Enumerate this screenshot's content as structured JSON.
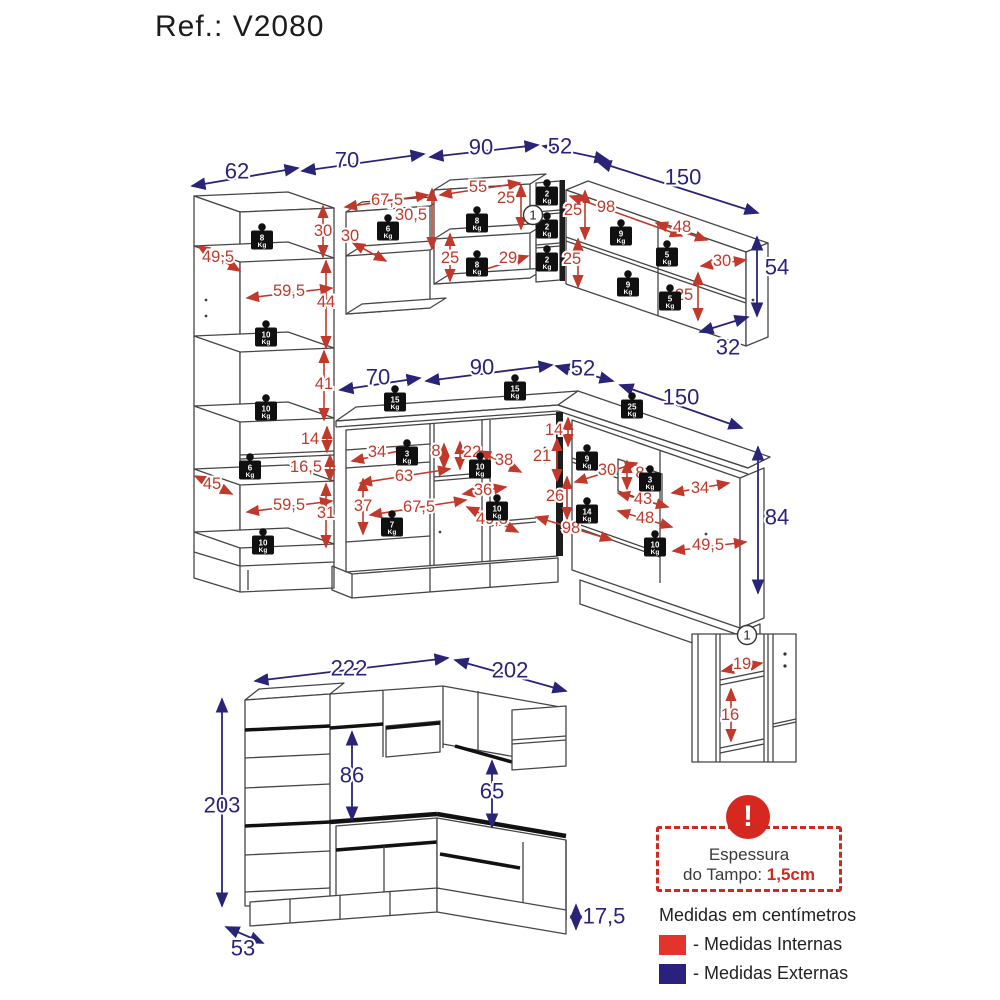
{
  "title": "Ref.: V2080",
  "colors": {
    "internal": "#c0392b",
    "external": "#2a2478",
    "legend_internal": "#e2342a",
    "legend_external": "#2a2080",
    "warning": "#d6281e"
  },
  "legend": {
    "thickness_line1": "Espessura",
    "thickness_line2": "do Tampo: ",
    "thickness_value": "1,5cm",
    "warning_glyph": "!",
    "units_note": "Medidas em centímetros",
    "internal_label": "- Medidas Internas",
    "external_label": "- Medidas Externas"
  },
  "diagram": {
    "dims": [
      {
        "t": "62",
        "x": 237,
        "y": 171,
        "c": "e",
        "a": [
          192,
          186,
          298,
          168
        ]
      },
      {
        "t": "70",
        "x": 347,
        "y": 160,
        "c": "e",
        "a": [
          302,
          171,
          424,
          154
        ]
      },
      {
        "t": "90",
        "x": 481,
        "y": 147,
        "c": "e",
        "a": [
          430,
          157,
          538,
          145
        ]
      },
      {
        "t": "52",
        "x": 560,
        "y": 146,
        "c": "e",
        "a": [
          543,
          146,
          608,
          160
        ]
      },
      {
        "t": "150",
        "x": 683,
        "y": 177,
        "c": "e",
        "a": [
          598,
          162,
          758,
          213
        ]
      },
      {
        "t": "54",
        "x": 777,
        "y": 267,
        "c": "e",
        "a": [
          757,
          237,
          757,
          316
        ]
      },
      {
        "t": "32",
        "x": 728,
        "y": 347,
        "c": "e",
        "a": [
          700,
          332,
          748,
          317
        ]
      },
      {
        "t": "70",
        "x": 378,
        "y": 377,
        "c": "e",
        "a": [
          340,
          390,
          420,
          378
        ]
      },
      {
        "t": "90",
        "x": 482,
        "y": 367,
        "c": "e",
        "a": [
          426,
          381,
          552,
          365
        ]
      },
      {
        "t": "52",
        "x": 583,
        "y": 368,
        "c": "e",
        "a": [
          556,
          366,
          613,
          381
        ]
      },
      {
        "t": "150",
        "x": 681,
        "y": 397,
        "c": "e",
        "a": [
          620,
          385,
          742,
          428
        ]
      },
      {
        "t": "84",
        "x": 777,
        "y": 517,
        "c": "e",
        "a": [
          758,
          447,
          758,
          593
        ]
      },
      {
        "t": "222",
        "x": 349,
        "y": 668,
        "c": "e",
        "a": [
          255,
          681,
          448,
          658
        ]
      },
      {
        "t": "202",
        "x": 510,
        "y": 670,
        "c": "e",
        "a": [
          455,
          660,
          566,
          691
        ]
      },
      {
        "t": "203",
        "x": 222,
        "y": 805,
        "c": "e",
        "a": [
          222,
          699,
          222,
          906
        ]
      },
      {
        "t": "86",
        "x": 352,
        "y": 775,
        "c": "e",
        "a": [
          352,
          732,
          352,
          820
        ]
      },
      {
        "t": "65",
        "x": 492,
        "y": 791,
        "c": "e",
        "a": [
          492,
          761,
          492,
          827
        ]
      },
      {
        "t": "53",
        "x": 243,
        "y": 948,
        "c": "e",
        "a": [
          226,
          927,
          263,
          943
        ]
      },
      {
        "t": "17,5",
        "x": 604,
        "y": 916,
        "c": "e",
        "a": [
          576,
          905,
          576,
          929
        ]
      },
      {
        "t": "49,5",
        "x": 218,
        "y": 257,
        "c": "i",
        "a": [
          198,
          246,
          240,
          271
        ]
      },
      {
        "t": "30",
        "x": 323,
        "y": 231,
        "c": "i",
        "a": [
          323,
          206,
          323,
          257
        ]
      },
      {
        "t": "59,5",
        "x": 289,
        "y": 291,
        "c": "i",
        "a": [
          247,
          298,
          332,
          288
        ]
      },
      {
        "t": "44",
        "x": 326,
        "y": 302,
        "c": "i",
        "a": [
          326,
          261,
          326,
          348
        ]
      },
      {
        "t": "41",
        "x": 324,
        "y": 384,
        "c": "i",
        "a": [
          324,
          351,
          324,
          420
        ]
      },
      {
        "t": "14",
        "x": 310,
        "y": 439,
        "c": "i",
        "a": [
          327,
          427,
          327,
          452
        ]
      },
      {
        "t": "16,5",
        "x": 306,
        "y": 467,
        "c": "i",
        "a": [
          330,
          455,
          330,
          481
        ]
      },
      {
        "t": "59,5",
        "x": 289,
        "y": 505,
        "c": "i",
        "a": [
          247,
          512,
          332,
          501
        ]
      },
      {
        "t": "31",
        "x": 326,
        "y": 513,
        "c": "i",
        "a": [
          326,
          484,
          326,
          547
        ]
      },
      {
        "t": "45",
        "x": 212,
        "y": 484,
        "c": "i",
        "a": [
          195,
          476,
          232,
          494
        ]
      },
      {
        "t": "67,5",
        "x": 387,
        "y": 200,
        "c": "i",
        "a": [
          345,
          207,
          428,
          195
        ]
      },
      {
        "t": "30,5",
        "x": 411,
        "y": 215,
        "c": "i",
        "a": [
          432,
          189,
          432,
          249
        ]
      },
      {
        "t": "30",
        "x": 350,
        "y": 236,
        "c": "i",
        "a": [
          353,
          243,
          386,
          261
        ]
      },
      {
        "t": "55",
        "x": 478,
        "y": 187,
        "c": "i",
        "a": [
          440,
          195,
          520,
          183
        ]
      },
      {
        "t": "25",
        "x": 506,
        "y": 198,
        "c": "i",
        "a": [
          521,
          185,
          521,
          229
        ]
      },
      {
        "t": "25",
        "x": 450,
        "y": 258,
        "c": "i",
        "a": [
          450,
          234,
          450,
          281
        ]
      },
      {
        "t": "29",
        "x": 508,
        "y": 258,
        "c": "i",
        "a": [
          470,
          274,
          528,
          256
        ]
      },
      {
        "t": "25",
        "x": 573,
        "y": 210,
        "c": "i",
        "a": [
          585,
          191,
          585,
          239
        ]
      },
      {
        "t": "98",
        "x": 606,
        "y": 207,
        "c": "i",
        "a": [
          570,
          196,
          682,
          236
        ]
      },
      {
        "t": "48",
        "x": 682,
        "y": 227,
        "c": "i",
        "a": [
          656,
          223,
          707,
          240
        ]
      },
      {
        "t": "30",
        "x": 722,
        "y": 261,
        "c": "i",
        "a": [
          701,
          266,
          746,
          260
        ]
      },
      {
        "t": "25",
        "x": 572,
        "y": 259,
        "c": "i",
        "a": [
          578,
          239,
          578,
          287
        ]
      },
      {
        "t": "25",
        "x": 684,
        "y": 295,
        "c": "i",
        "a": [
          698,
          273,
          698,
          320
        ]
      },
      {
        "t": "14",
        "x": 554,
        "y": 430,
        "c": "i",
        "a": [
          568,
          418,
          568,
          446
        ]
      },
      {
        "t": "34",
        "x": 377,
        "y": 452,
        "c": "i",
        "a": [
          352,
          461,
          408,
          449
        ]
      },
      {
        "t": "8",
        "x": 436,
        "y": 451,
        "c": "i",
        "a": [
          444,
          444,
          444,
          468
        ]
      },
      {
        "t": "63",
        "x": 404,
        "y": 476,
        "c": "i",
        "a": [
          360,
          483,
          450,
          469
        ]
      },
      {
        "t": "37",
        "x": 363,
        "y": 506,
        "c": "i",
        "a": [
          363,
          479,
          363,
          534
        ]
      },
      {
        "t": "67,5",
        "x": 419,
        "y": 507,
        "c": "i",
        "a": [
          370,
          515,
          466,
          500
        ]
      },
      {
        "t": "22",
        "x": 472,
        "y": 452,
        "c": "i",
        "a": [
          460,
          442,
          460,
          469
        ]
      },
      {
        "t": "38",
        "x": 504,
        "y": 460,
        "c": "i",
        "a": [
          479,
          451,
          521,
          472
        ]
      },
      {
        "t": "36",
        "x": 483,
        "y": 490,
        "c": "i",
        "a": [
          463,
          494,
          506,
          487
        ]
      },
      {
        "t": "49,5",
        "x": 492,
        "y": 519,
        "c": "i",
        "a": [
          467,
          507,
          518,
          532
        ]
      },
      {
        "t": "21",
        "x": 542,
        "y": 456,
        "c": "i",
        "a": [
          557,
          439,
          557,
          481
        ]
      },
      {
        "t": "26",
        "x": 555,
        "y": 496,
        "c": "i",
        "a": [
          567,
          477,
          567,
          519
        ]
      },
      {
        "t": "98",
        "x": 571,
        "y": 528,
        "c": "i",
        "a": [
          536,
          517,
          612,
          540
        ]
      },
      {
        "t": "30",
        "x": 607,
        "y": 470,
        "c": "i",
        "a": [
          575,
          482,
          637,
          463
        ]
      },
      {
        "t": "8",
        "x": 640,
        "y": 473,
        "c": "i",
        "a": [
          627,
          461,
          627,
          489
        ]
      },
      {
        "t": "43",
        "x": 643,
        "y": 499,
        "c": "i",
        "a": [
          618,
          493,
          668,
          507
        ]
      },
      {
        "t": "34",
        "x": 700,
        "y": 488,
        "c": "i",
        "a": [
          672,
          493,
          729,
          483
        ]
      },
      {
        "t": "48",
        "x": 645,
        "y": 518,
        "c": "i",
        "a": [
          618,
          511,
          672,
          527
        ]
      },
      {
        "t": "49,5",
        "x": 708,
        "y": 545,
        "c": "i",
        "a": [
          673,
          551,
          746,
          542
        ]
      },
      {
        "t": "19",
        "x": 742,
        "y": 664,
        "c": "i",
        "a": [
          722,
          671,
          762,
          663
        ]
      },
      {
        "t": "16",
        "x": 730,
        "y": 715,
        "c": "i",
        "a": [
          731,
          689,
          731,
          741
        ]
      }
    ],
    "weights": [
      {
        "kg": "8",
        "x": 262,
        "y": 240
      },
      {
        "kg": "10",
        "x": 266,
        "y": 337
      },
      {
        "kg": "10",
        "x": 266,
        "y": 411
      },
      {
        "kg": "6",
        "x": 250,
        "y": 470
      },
      {
        "kg": "10",
        "x": 263,
        "y": 545
      },
      {
        "kg": "6",
        "x": 388,
        "y": 231
      },
      {
        "kg": "8",
        "x": 477,
        "y": 223
      },
      {
        "kg": "8",
        "x": 477,
        "y": 267
      },
      {
        "kg": "2",
        "x": 547,
        "y": 196
      },
      {
        "kg": "2",
        "x": 547,
        "y": 229
      },
      {
        "kg": "2",
        "x": 547,
        "y": 262
      },
      {
        "kg": "9",
        "x": 621,
        "y": 236
      },
      {
        "kg": "5",
        "x": 667,
        "y": 257
      },
      {
        "kg": "9",
        "x": 628,
        "y": 287
      },
      {
        "kg": "5",
        "x": 670,
        "y": 301
      },
      {
        "kg": "15",
        "x": 395,
        "y": 402
      },
      {
        "kg": "15",
        "x": 515,
        "y": 391
      },
      {
        "kg": "25",
        "x": 632,
        "y": 409
      },
      {
        "kg": "3",
        "x": 407,
        "y": 456
      },
      {
        "kg": "10",
        "x": 480,
        "y": 469
      },
      {
        "kg": "10",
        "x": 497,
        "y": 511
      },
      {
        "kg": "7",
        "x": 392,
        "y": 527
      },
      {
        "kg": "9",
        "x": 587,
        "y": 461
      },
      {
        "kg": "3",
        "x": 650,
        "y": 482
      },
      {
        "kg": "14",
        "x": 587,
        "y": 514
      },
      {
        "kg": "10",
        "x": 655,
        "y": 547
      }
    ],
    "markers": [
      {
        "t": "1",
        "x": 533,
        "y": 215
      },
      {
        "t": "1",
        "x": 747,
        "y": 635
      }
    ],
    "weight_unit": "Kg"
  }
}
